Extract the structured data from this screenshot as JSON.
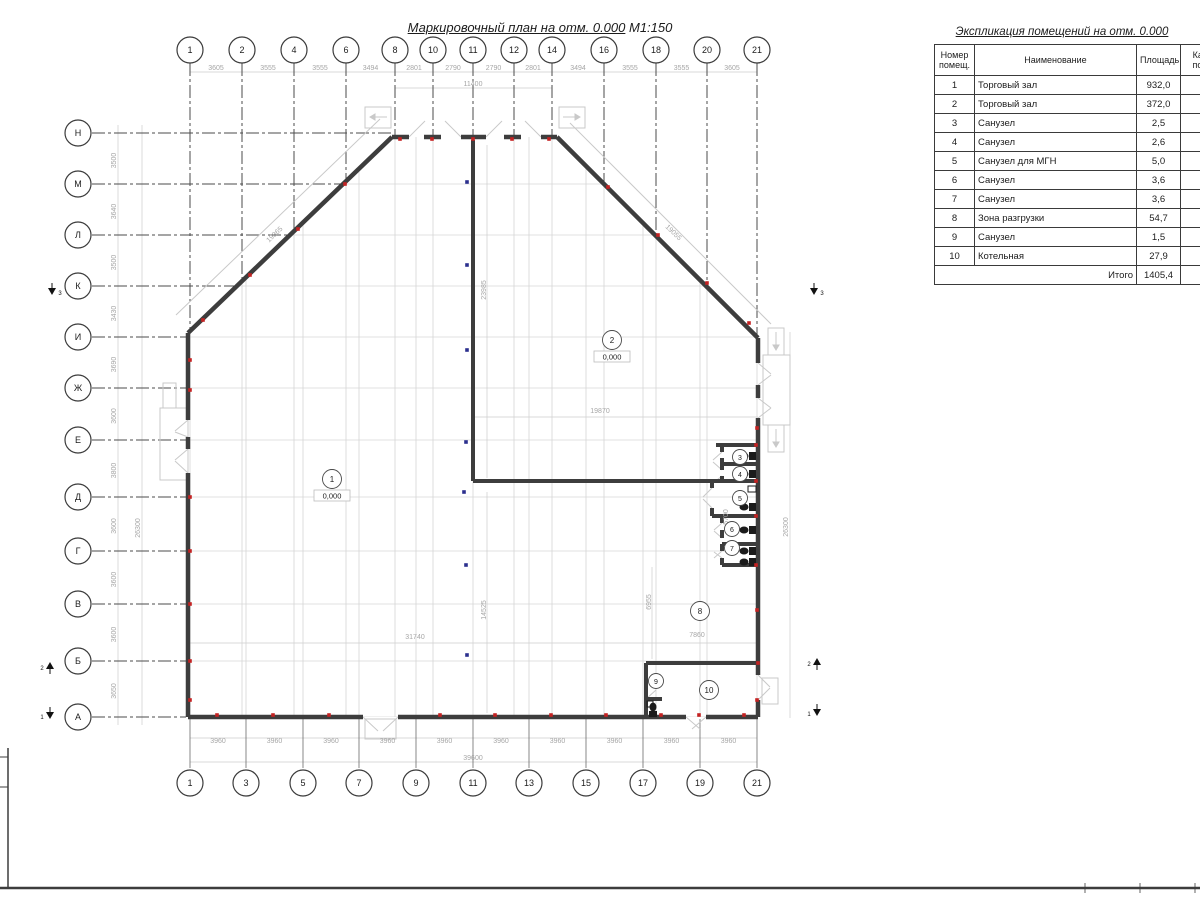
{
  "plan": {
    "title": "Маркировочный план на отм. 0.000",
    "scale": "М1:150",
    "axes": {
      "top": [
        {
          "label": "1",
          "x": 190
        },
        {
          "label": "2",
          "x": 242
        },
        {
          "label": "4",
          "x": 294
        },
        {
          "label": "6",
          "x": 346
        },
        {
          "label": "8",
          "x": 395
        },
        {
          "label": "10",
          "x": 433
        },
        {
          "label": "11",
          "x": 473
        },
        {
          "label": "12",
          "x": 514
        },
        {
          "label": "14",
          "x": 552
        },
        {
          "label": "16",
          "x": 604
        },
        {
          "label": "18",
          "x": 656
        },
        {
          "label": "20",
          "x": 707
        },
        {
          "label": "21",
          "x": 757
        }
      ],
      "bottom": [
        {
          "label": "1",
          "x": 190
        },
        {
          "label": "3",
          "x": 246
        },
        {
          "label": "5",
          "x": 303
        },
        {
          "label": "7",
          "x": 359
        },
        {
          "label": "9",
          "x": 416
        },
        {
          "label": "11",
          "x": 473
        },
        {
          "label": "13",
          "x": 529
        },
        {
          "label": "15",
          "x": 586
        },
        {
          "label": "17",
          "x": 643
        },
        {
          "label": "19",
          "x": 700
        },
        {
          "label": "21",
          "x": 757
        }
      ],
      "left": [
        {
          "label": "Н",
          "y": 133
        },
        {
          "label": "М",
          "y": 184
        },
        {
          "label": "Л",
          "y": 235
        },
        {
          "label": "К",
          "y": 286
        },
        {
          "label": "И",
          "y": 337
        },
        {
          "label": "Ж",
          "y": 388
        },
        {
          "label": "Е",
          "y": 440
        },
        {
          "label": "Д",
          "y": 497
        },
        {
          "label": "Г",
          "y": 551
        },
        {
          "label": "В",
          "y": 604
        },
        {
          "label": "Б",
          "y": 661
        },
        {
          "label": "А",
          "y": 717
        }
      ]
    },
    "dims": {
      "top_segments": [
        "3605",
        "3555",
        "3555",
        "3494",
        "2801",
        "2790",
        "2790",
        "2801",
        "3494",
        "3555",
        "3555",
        "3605"
      ],
      "top_overall": "39600",
      "top_mid": "11400",
      "bottom_segments": [
        "3960",
        "3960",
        "3960",
        "3960",
        "3960",
        "3960",
        "3960",
        "3960",
        "3960",
        "3960"
      ],
      "bottom_overall": "39600",
      "left_segments": [
        "3500",
        "3640",
        "3500",
        "3430",
        "3690",
        "3600",
        "3800",
        "3600",
        "3600",
        "3600",
        "3650"
      ],
      "left_overall": "26300",
      "right_overall": "26300",
      "floating": [
        {
          "text": "19865",
          "x": 276,
          "y": 236,
          "rot": -44
        },
        {
          "text": "19055",
          "x": 672,
          "y": 234,
          "rot": 44
        },
        {
          "text": "23985",
          "x": 486,
          "y": 290,
          "rot": -90
        },
        {
          "text": "19870",
          "x": 600,
          "y": 413,
          "rot": 0
        },
        {
          "text": "31740",
          "x": 415,
          "y": 639,
          "rot": 0
        },
        {
          "text": "14525",
          "x": 486,
          "y": 610,
          "rot": -90
        },
        {
          "text": "6955",
          "x": 651,
          "y": 602,
          "rot": -90
        },
        {
          "text": "7860",
          "x": 697,
          "y": 637,
          "rot": 0
        },
        {
          "text": "5700",
          "x": 728,
          "y": 517,
          "rot": -90
        }
      ]
    },
    "room_markers": [
      {
        "num": "1",
        "x": 332,
        "y": 479,
        "elev": "0,000",
        "big": true
      },
      {
        "num": "2",
        "x": 612,
        "y": 340,
        "elev": "0,000",
        "big": true
      },
      {
        "num": "3",
        "x": 740,
        "y": 457
      },
      {
        "num": "4",
        "x": 740,
        "y": 474
      },
      {
        "num": "5",
        "x": 740,
        "y": 498
      },
      {
        "num": "6",
        "x": 732,
        "y": 529
      },
      {
        "num": "7",
        "x": 732,
        "y": 548
      },
      {
        "num": "8",
        "x": 700,
        "y": 611,
        "big": true
      },
      {
        "num": "9",
        "x": 656,
        "y": 681
      },
      {
        "num": "10",
        "x": 709,
        "y": 690,
        "big": true
      }
    ],
    "section_markers": [
      {
        "label": "3",
        "x": 52,
        "y": 291,
        "dir": "down",
        "numside": "right"
      },
      {
        "label": "3",
        "x": 814,
        "y": 291,
        "dir": "down",
        "numside": "right"
      },
      {
        "label": "2",
        "x": 50,
        "y": 666,
        "dir": "up",
        "numside": "left"
      },
      {
        "label": "2",
        "x": 817,
        "y": 662,
        "dir": "up",
        "numside": "left"
      },
      {
        "label": "1",
        "x": 50,
        "y": 715,
        "dir": "down",
        "numside": "left"
      },
      {
        "label": "1",
        "x": 817,
        "y": 712,
        "dir": "down",
        "numside": "left"
      }
    ]
  },
  "explication": {
    "title": "Экспликация помещений на отм. 0.000",
    "headers": {
      "num": "Номер\nпомещ.",
      "name": "Наименование",
      "area": "Площадь",
      "cat": "Кат.\nпом"
    },
    "rows": [
      {
        "num": "1",
        "name": "Торговый зал",
        "area": "932,0"
      },
      {
        "num": "2",
        "name": "Торговый зал",
        "area": "372,0"
      },
      {
        "num": "3",
        "name": "Санузел",
        "area": "2,5"
      },
      {
        "num": "4",
        "name": "Санузел",
        "area": "2,6"
      },
      {
        "num": "5",
        "name": "Санузел для МГН",
        "area": "5,0"
      },
      {
        "num": "6",
        "name": "Санузел",
        "area": "3,6"
      },
      {
        "num": "7",
        "name": "Санузел",
        "area": "3,6"
      },
      {
        "num": "8",
        "name": "Зона разгрузки",
        "area": "54,7"
      },
      {
        "num": "9",
        "name": "Санузел",
        "area": "1,5"
      },
      {
        "num": "10",
        "name": "Котельная",
        "area": "27,9"
      }
    ],
    "total_label": "Итого",
    "total_value": "1405,4"
  },
  "colors": {
    "wall": "#3d3d3d",
    "grid_dark": "#4b4b4b",
    "grid_light": "#d6d6d6",
    "dim_line": "#cccccc",
    "dim_text": "#a6a6a6",
    "red_marker": "#c42222",
    "blue_marker": "#2b2f8e"
  }
}
